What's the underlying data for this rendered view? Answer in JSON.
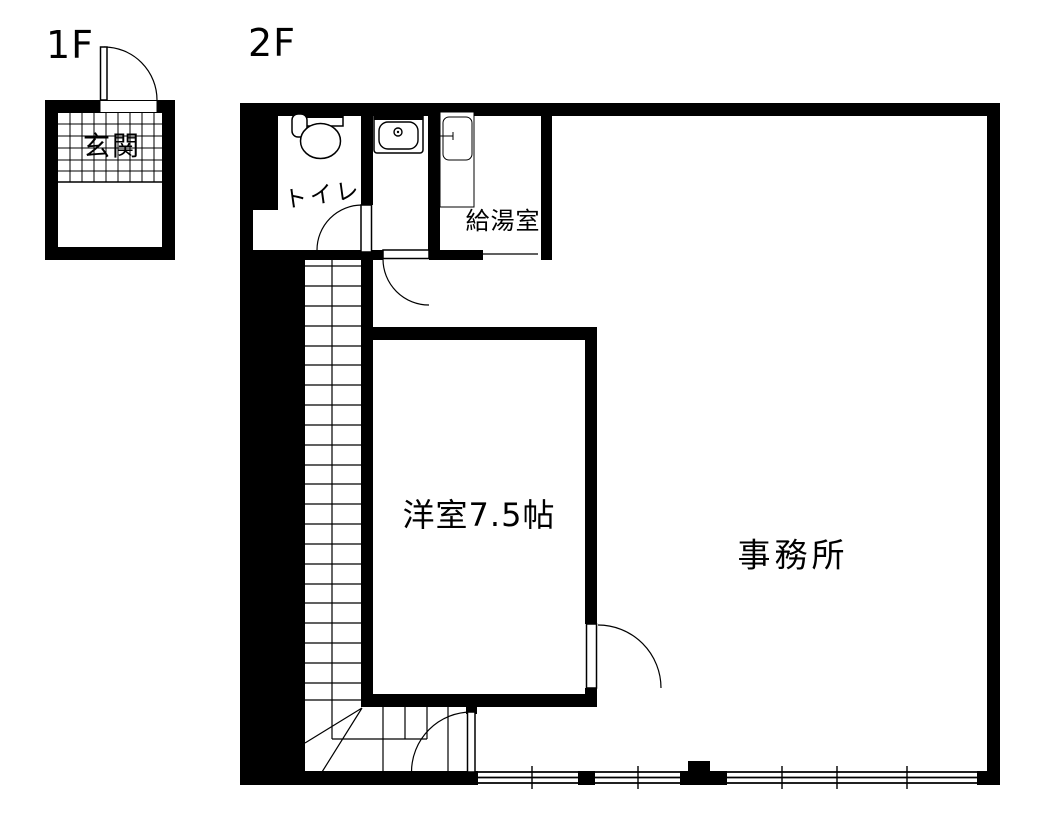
{
  "drawing_title": "floor-plan",
  "floors": {
    "f1": {
      "label": "1F"
    },
    "f2": {
      "label": "2F"
    }
  },
  "rooms": {
    "genkan": "玄関",
    "toilet": "トイレ",
    "kyutoshitsu": "給湯室",
    "yoshitsu": "洋室7.5帖",
    "jimusho": "事務所"
  },
  "fixtures": {
    "toilet_icon": "western-toilet",
    "washbasin_icon": "washbasin",
    "kitchen_counter_icon": "kitchen-sink-counter",
    "staircase": "u-turn-staircase",
    "doors": "hinged-door-swings",
    "windows": "sliding-windows"
  },
  "colors": {
    "wall": "#000000",
    "line": "#000000",
    "background": "#ffffff"
  }
}
